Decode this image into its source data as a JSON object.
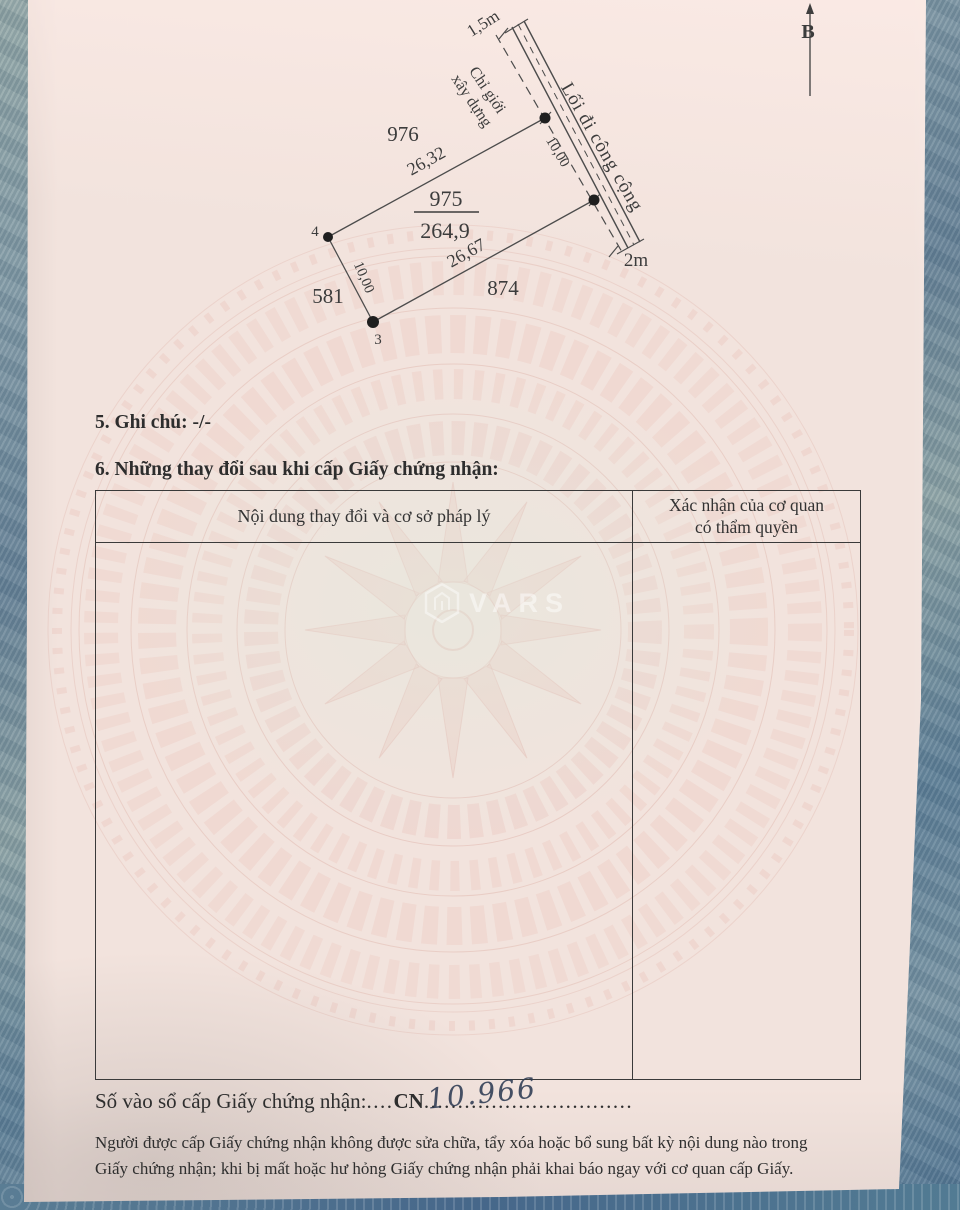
{
  "plan": {
    "compass_label": "B",
    "parcel_number": "975",
    "parcel_area": "264,9",
    "neighbor_top": "976",
    "neighbor_left": "581",
    "neighbor_bottom": "874",
    "length_top": "26,32",
    "length_bottom": "26,67",
    "length_left": "10,00",
    "length_right": "10,00",
    "vertex_left": "4",
    "vertex_bottom": "3",
    "road_label": "Lối đi công cộng",
    "road_width_top": "1,5m",
    "road_width_bottom": "2m",
    "setback_label_line1": "Chỉ giới",
    "setback_label_line2": "xây dựng"
  },
  "sections": {
    "note_heading": "5. Ghi chú:",
    "note_value": "-/-",
    "changes_heading": "6. Những thay đổi sau khi cấp Giấy chứng nhận:"
  },
  "table": {
    "col1_header": "Nội dung thay đổi và cơ sở pháp lý",
    "col2_header_line1": "Xác nhận của cơ quan",
    "col2_header_line2": "có thẩm quyền"
  },
  "registry": {
    "label": "Số vào sổ cấp Giấy chứng nhận:",
    "dots_before_code": "....",
    "code": "CN",
    "dots_after_code": "...............................",
    "handwritten_number": "10.966"
  },
  "footer": {
    "line1": "Người được cấp Giấy chứng nhận không được sửa chữa, tẩy xóa hoặc bổ sung bất kỳ nội dung nào trong",
    "line2": "Giấy chứng nhận; khi bị mất hoặc hư hỏng Giấy chứng nhận phải khai báo ngay với cơ quan cấp Giấy."
  },
  "watermark": {
    "text": "VARS"
  },
  "colors": {
    "paper": "#f2e3dd",
    "pattern_pink": "#e6b9ae",
    "fabric_blue": "#7e94a0",
    "ink": "#3a3a3a",
    "handwriting_ink": "#31425c"
  }
}
